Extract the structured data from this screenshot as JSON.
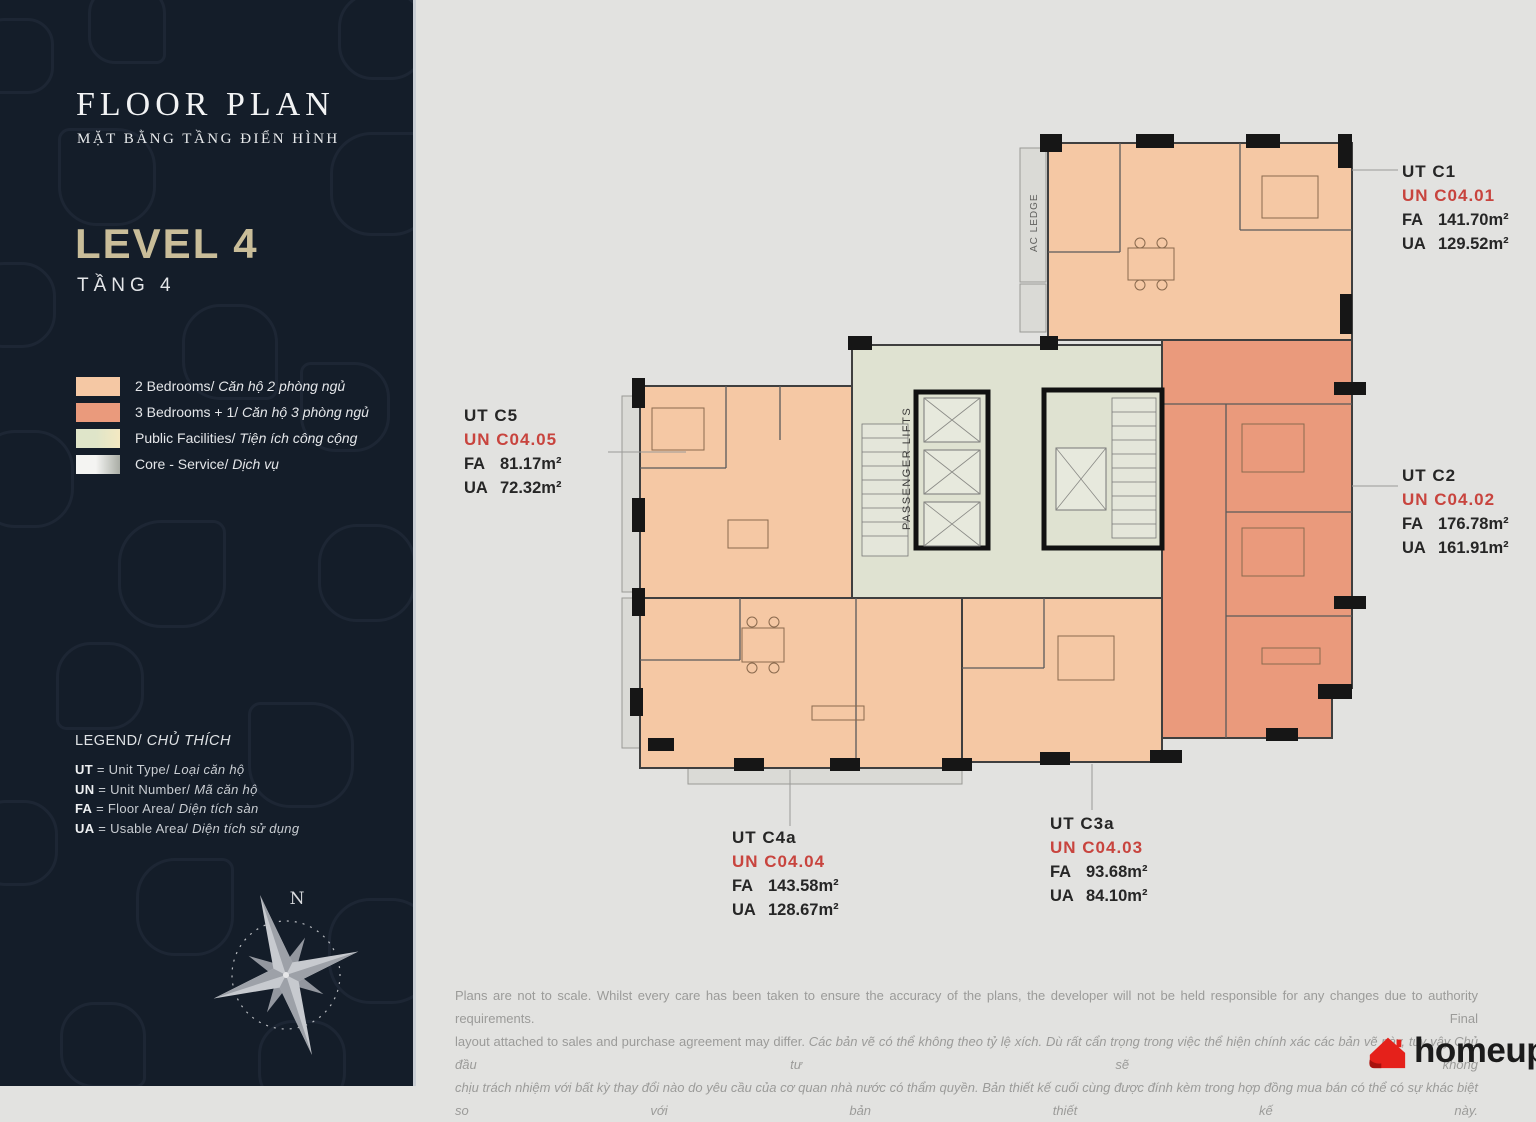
{
  "colors": {
    "sidebar_bg": "#141d29",
    "canvas_bg": "#e2e2e0",
    "level_accent": "#c9bd99",
    "two_bed": "#f5c8a4",
    "three_bed": "#ea9a7c",
    "core_fill": "#dfe2d1",
    "lift_fill": "#e7e9dd",
    "ledge_fill": "#dadad6",
    "wall": "#161616",
    "unit_red": "#c8443e",
    "logo_red": "#e5211b"
  },
  "sidebar": {
    "title": "FLOOR PLAN",
    "subtitle": "MẶT BẰNG TẦNG ĐIỂN HÌNH",
    "level": "LEVEL 4",
    "level_vi": "TẦNG 4",
    "legend_items": [
      {
        "en": "2 Bedrooms/",
        "vi": "Căn hộ 2 phòng ngủ",
        "c1": "#f5c8a4",
        "c2": "#f5c8a4"
      },
      {
        "en": "3 Bedrooms + 1/",
        "vi": "Căn hộ 3 phòng ngủ",
        "c1": "#ea9a7c",
        "c2": "#ea9a7c"
      },
      {
        "en": "Public Facilities/",
        "vi": "Tiện ích công cộng",
        "c1": "#dfe5c9",
        "c2": "#f4e9c2"
      },
      {
        "en": "Core - Service/",
        "vi": "Dịch vụ",
        "c1": "#f4f4f2",
        "c2": "#a9ada5"
      }
    ],
    "key_heading_en": "LEGEND/",
    "key_heading_vi": "CHỦ THÍCH",
    "key_rows": [
      {
        "abbr": "UT",
        "en": " = Unit Type/ ",
        "vi": "Loại căn hộ"
      },
      {
        "abbr": "UN",
        "en": " = Unit Number/ ",
        "vi": "Mã căn hộ"
      },
      {
        "abbr": "FA",
        "en": " = Floor Area/ ",
        "vi": "Diện tích sàn"
      },
      {
        "abbr": "UA",
        "en": " = Usable Area/ ",
        "vi": "Diện tích sử dụng"
      }
    ],
    "compass_north": "N"
  },
  "plan": {
    "ac_ledge": "AC LEDGE",
    "passenger_lifts": "PASSENGER LIFTS"
  },
  "unit_labels": [
    {
      "type": "UT C1",
      "unit_no": "UN C04.01",
      "fa_key": "FA",
      "fa_val": "141.70m²",
      "ua_key": "UA",
      "ua_val": "129.52m²"
    },
    {
      "type": "UT C2",
      "unit_no": "UN C04.02",
      "fa_key": "FA",
      "fa_val": "176.78m²",
      "ua_key": "UA",
      "ua_val": "161.91m²"
    },
    {
      "type": "UT C5",
      "unit_no": "UN C04.05",
      "fa_key": "FA",
      "fa_val": "81.17m²",
      "ua_key": "UA",
      "ua_val": "72.32m²"
    },
    {
      "type": "UT C4a",
      "unit_no": "UN C04.04",
      "fa_key": "FA",
      "fa_val": "143.58m²",
      "ua_key": "UA",
      "ua_val": "128.67m²"
    },
    {
      "type": "UT C3a",
      "unit_no": "UN C04.03",
      "fa_key": "FA",
      "fa_val": "93.68m²",
      "ua_key": "UA",
      "ua_val": "84.10m²"
    }
  ],
  "disclaimer": {
    "line1": "Plans are not to scale. Whilst every care has been taken to ensure the accuracy of the plans, the developer will not be held responsible for any changes due to authority requirements. Final",
    "line2_en": "layout attached to sales and purchase agreement may differ. ",
    "line2_vi": "Các bản vẽ có thể không theo tỷ lệ xích. Dù rất cẩn trọng trong việc thể hiện chính xác các bản vẽ này, tuy vậy Chủ đầu tư sẽ không",
    "line3": "chịu trách nhiệm với bất kỳ thay đổi nào do yêu cầu của cơ quan nhà nước có thẩm quyền. Bản thiết kế cuối cùng được đính kèm trong hợp đồng mua bán có thể có sự khác biệt so với bản thiết kế này."
  },
  "logo": {
    "name": "homeup"
  }
}
